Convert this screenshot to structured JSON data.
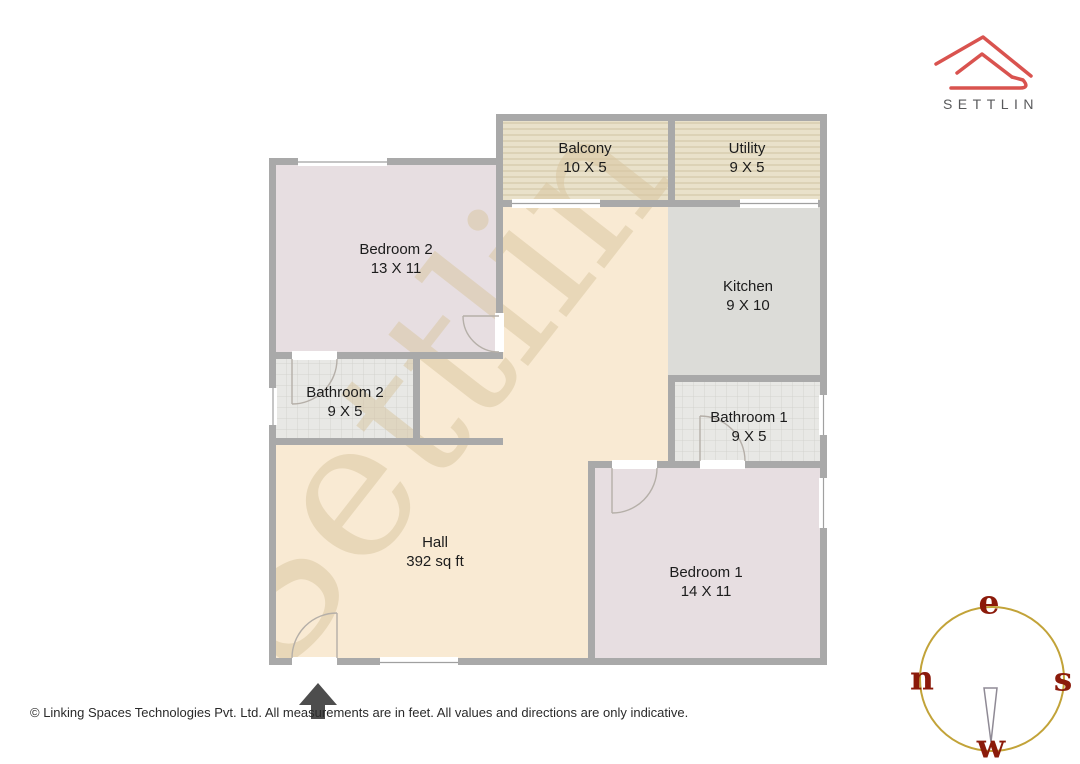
{
  "brand": {
    "name": "SETTLIN"
  },
  "watermark": {
    "text": "Settlin"
  },
  "plan": {
    "rooms": [
      {
        "name": "Balcony",
        "dims": "10 X 5"
      },
      {
        "name": "Utility",
        "dims": "9 X 5"
      },
      {
        "name": "Bedroom 2",
        "dims": "13 X 11"
      },
      {
        "name": "Kitchen",
        "dims": "9 X 10"
      },
      {
        "name": "Bathroom 2",
        "dims": "9 X 5"
      },
      {
        "name": "Bathroom 1",
        "dims": "9 X 5"
      },
      {
        "name": "Hall",
        "dims": "392 sq ft"
      },
      {
        "name": "Bedroom 1",
        "dims": "14 X 11"
      }
    ]
  },
  "compass": {
    "top": "e",
    "left": "n",
    "right": "s",
    "bottom": "w"
  },
  "footer": {
    "text": "© Linking Spaces Technologies Pvt. Ltd. All measurements are in feet. All values and directions are only indicative."
  },
  "colors": {
    "wall": "#a9a9a9",
    "bedroom_fill": "#e7dee1",
    "hall_fill": "#f9ead3",
    "kitchen_fill": "#dcdcd8",
    "bathroom_fill": "#e8e8e5",
    "balcony_fill": "#e9e1ca",
    "watermark": "#d8c59e",
    "logo_red": "#d9534f",
    "compass_ring": "#c2a339",
    "compass_letters": "#8b1a0a",
    "north_arrow": "#4d4d4d"
  }
}
